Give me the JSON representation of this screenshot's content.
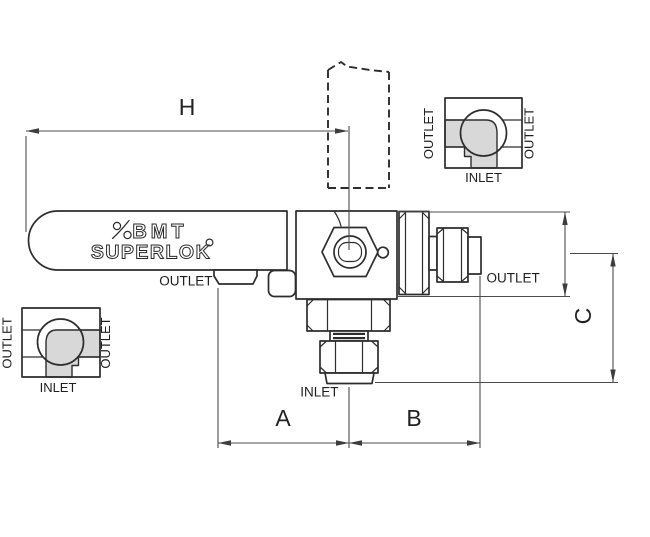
{
  "drawing": {
    "description": "BMT Superlok 3-way ball valve technical dimension drawing, side view, bottom inlet",
    "brand": {
      "name": "BMT",
      "sub": "SUPERLOK",
      "registered_symbol": "degree-circle",
      "mark": "superlok-swoosh-mark"
    },
    "dimensions": {
      "h": "H",
      "a": "A",
      "b": "B",
      "c": "C"
    },
    "ports": {
      "left_outlet": "OUTLET",
      "right_outlet": "OUTLET",
      "bottom_inlet": "INLET"
    },
    "schematic_top_right": {
      "left_label": "OUTLET",
      "right_label": "OUTLET",
      "bottom_label": "INLET",
      "flow_path": "inlet-to-left-outlet"
    },
    "schematic_bottom_left": {
      "left_label": "OUTLET",
      "right_label": "OUTLET",
      "bottom_label": "INLET",
      "flow_path": "inlet-to-right-outlet"
    },
    "colors": {
      "outline": "#2d2d2d",
      "dimension_lines": "#4d4d4d",
      "flow_fill": "#d8d8d8",
      "background": "#ffffff"
    }
  }
}
